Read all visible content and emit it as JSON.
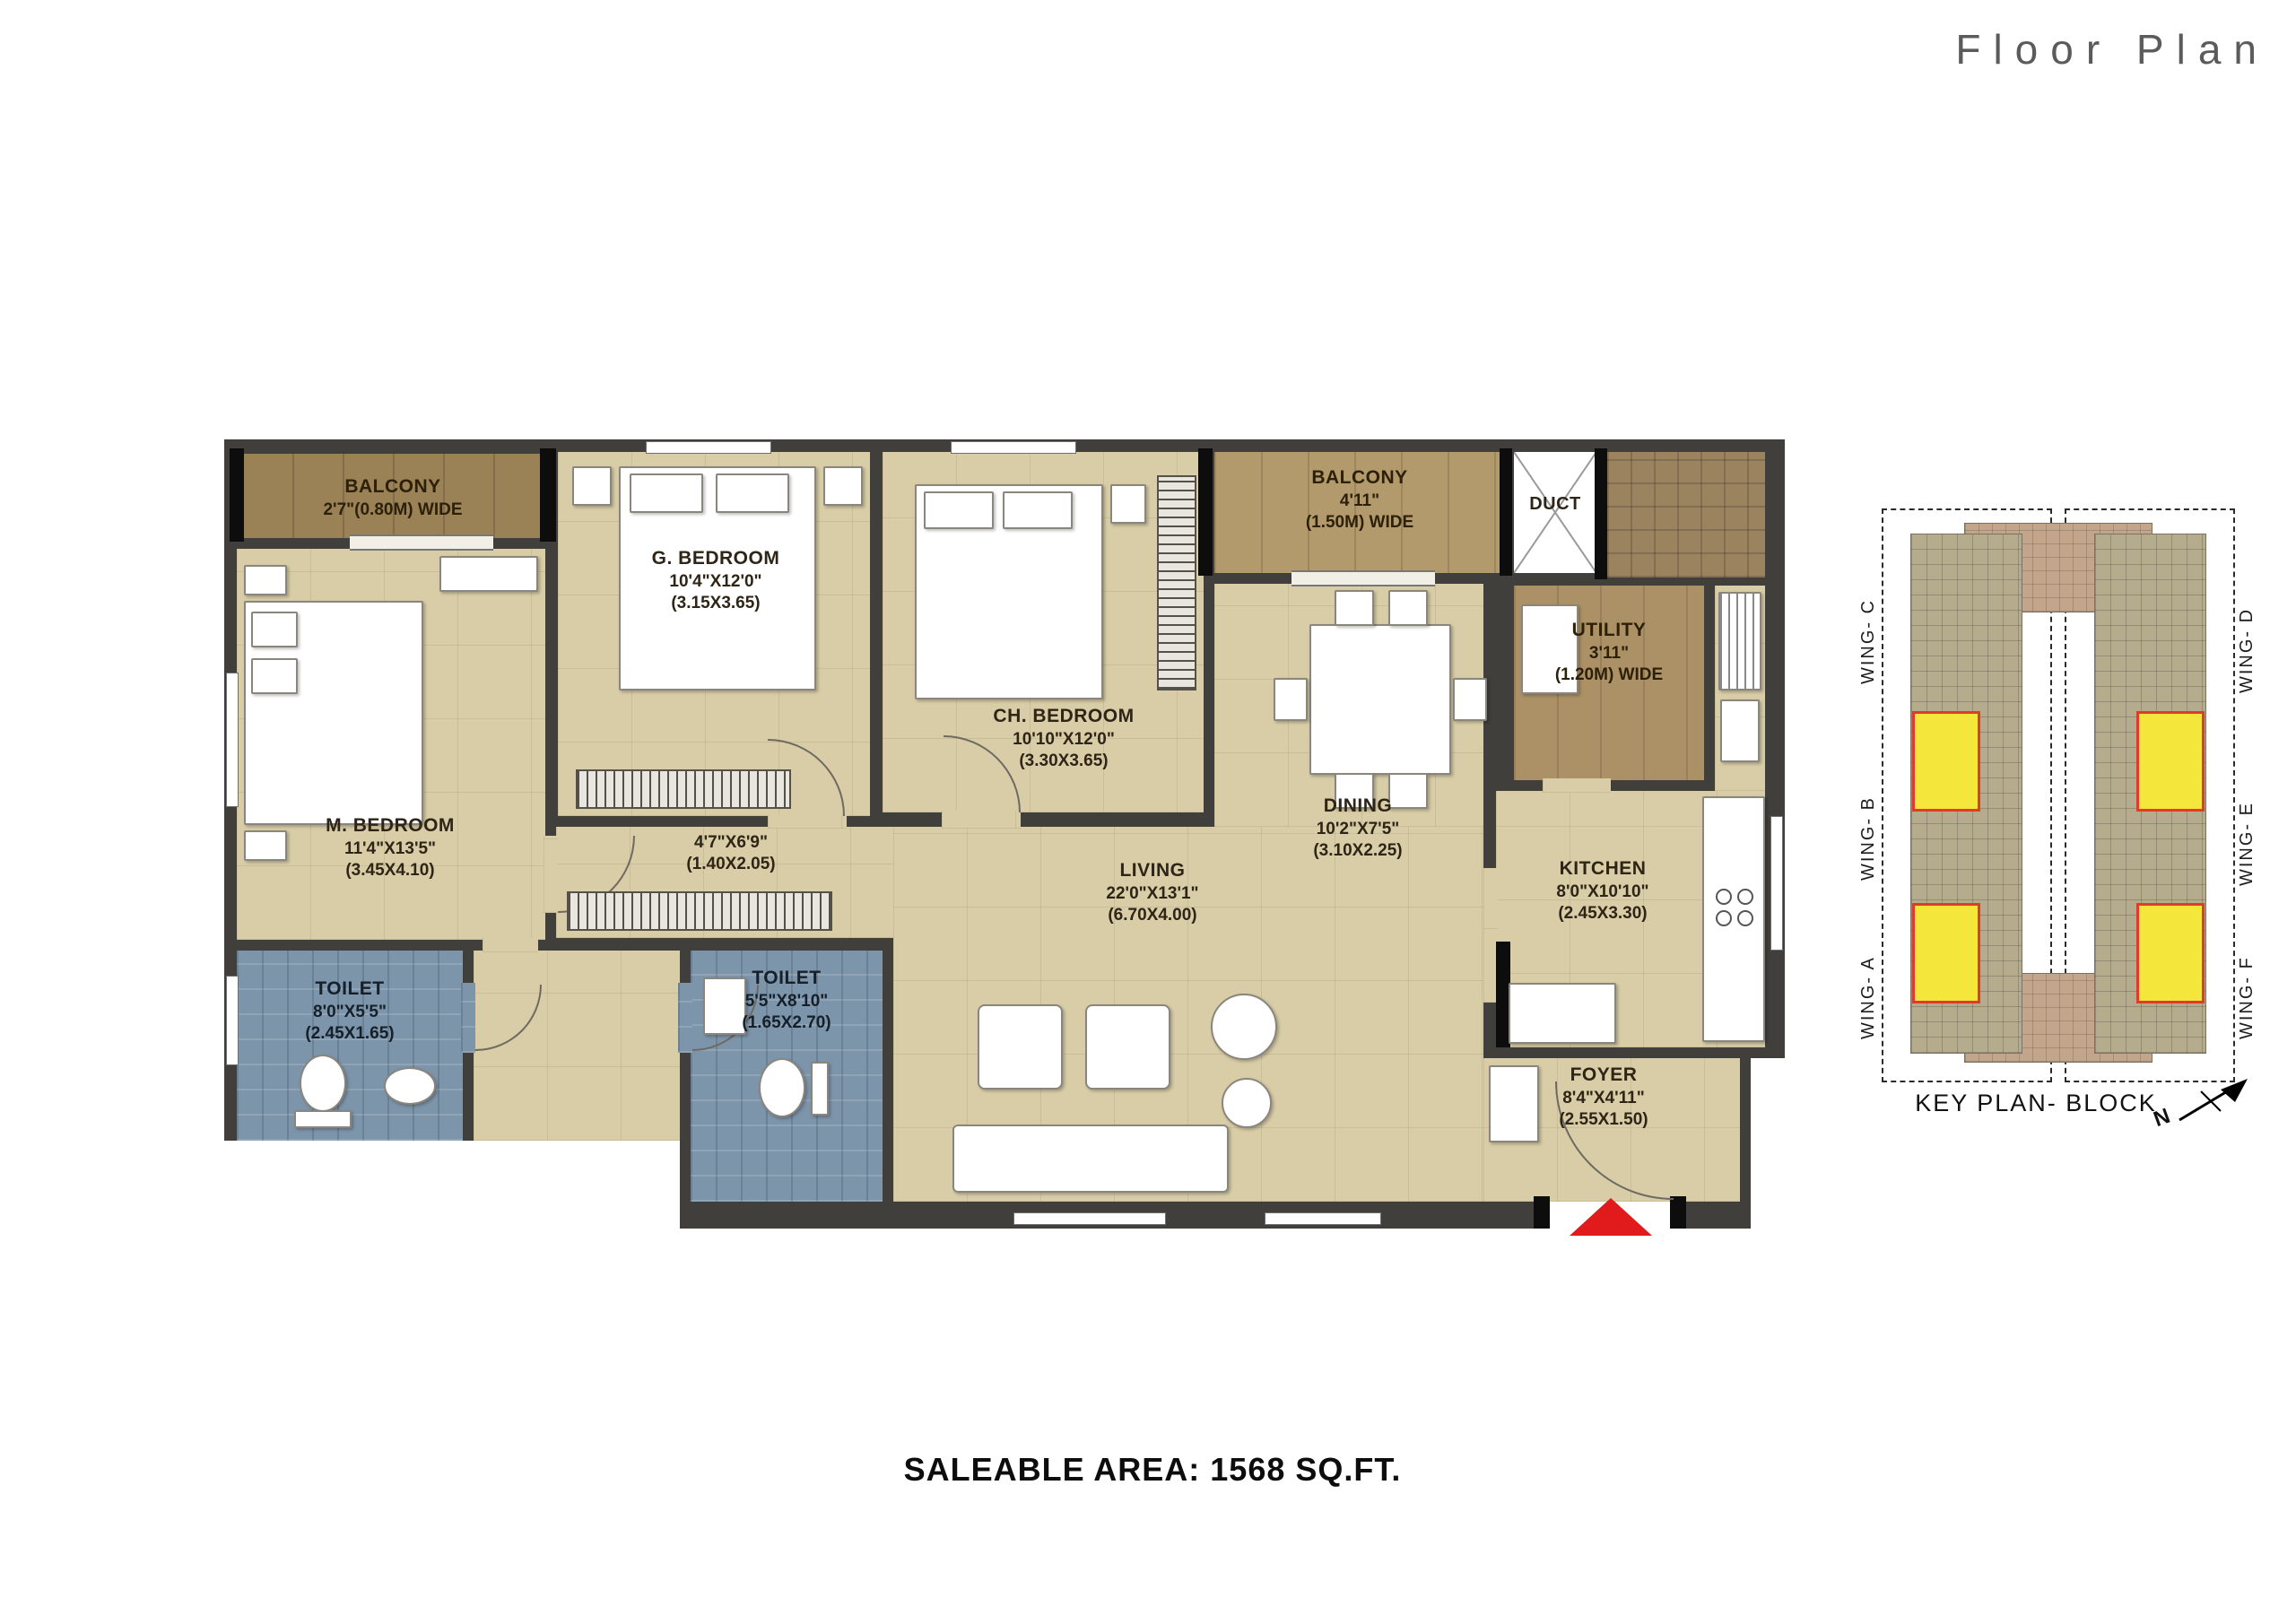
{
  "header": {
    "title": "Floor Plan"
  },
  "footer": {
    "saleable_area": "SALEABLE AREA: 1568 SQ.FT."
  },
  "rooms": {
    "balcony_left": {
      "name": "BALCONY",
      "dims": "2'7\"(0.80M) WIDE"
    },
    "m_bedroom": {
      "name": "M. BEDROOM",
      "dims": "11'4\"X13'5\"",
      "metric": "(3.45X4.10)"
    },
    "g_bedroom": {
      "name": "G. BEDROOM",
      "dims": "10'4\"X12'0\"",
      "metric": "(3.15X3.65)"
    },
    "ch_bedroom": {
      "name": "CH. BEDROOM",
      "dims": "10'10\"X12'0\"",
      "metric": "(3.30X3.65)"
    },
    "balcony_right": {
      "name": "BALCONY",
      "dims": "4'11\"",
      "metric": "(1.50M) WIDE"
    },
    "duct": {
      "name": "DUCT"
    },
    "utility": {
      "name": "UTILITY",
      "dims": "3'11\"",
      "metric": "(1.20M) WIDE"
    },
    "passage": {
      "dims": "4'7\"X6'9\"",
      "metric": "(1.40X2.05)"
    },
    "toilet_left": {
      "name": "TOILET",
      "dims": "8'0\"X5'5\"",
      "metric": "(2.45X1.65)"
    },
    "toilet_bottom": {
      "name": "TOILET",
      "dims": "5'5\"X8'10\"",
      "metric": "(1.65X2.70)"
    },
    "living": {
      "name": "LIVING",
      "dims": "22'0\"X13'1\"",
      "metric": "(6.70X4.00)"
    },
    "dining": {
      "name": "DINING",
      "dims": "10'2\"X7'5\"",
      "metric": "(3.10X2.25)"
    },
    "kitchen": {
      "name": "KITCHEN",
      "dims": "8'0\"X10'10\"",
      "metric": "(2.45X3.30)"
    },
    "foyer": {
      "name": "FOYER",
      "dims": "8'4\"X4'11\"",
      "metric": "(2.55X1.50)"
    }
  },
  "key_plan": {
    "title": "KEY PLAN- BLOCK",
    "north_label": "N",
    "wings_left": [
      "WING- C",
      "WING- B",
      "WING- A"
    ],
    "wings_right": [
      "WING- D",
      "WING- E",
      "WING- F"
    ]
  },
  "colors": {
    "floor": "#d8cda6",
    "wall": "#413f3c",
    "balcony": "#9a8156",
    "balcony_light": "#b29a6c",
    "toilet": "#7d95ab",
    "utility": "#ac9166",
    "flat_highlight": "#f5e63c",
    "flat_highlight_border": "#e03a2b",
    "entrance_arrow": "#e11b1b"
  }
}
